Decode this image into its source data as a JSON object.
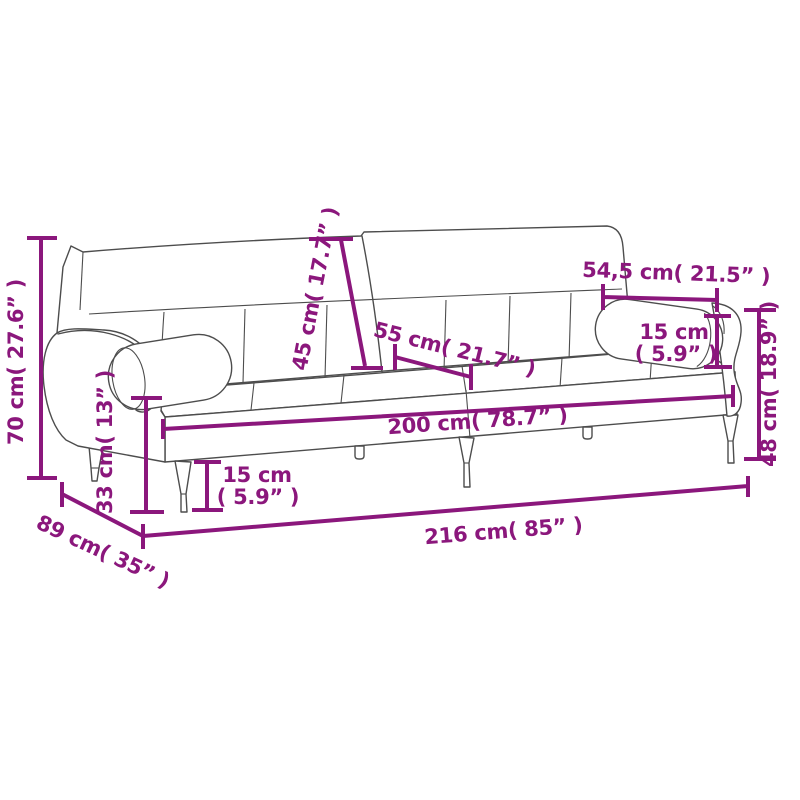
{
  "diagram": {
    "kind": "sofa-bed-dimension-diagram",
    "accent_color": "#8B177C",
    "line_art_color": "#4d4d4d",
    "background_color": "#ffffff"
  },
  "dimensions": {
    "overall_height": {
      "cm": 70,
      "in": 27.6,
      "label": "70 cm( 27.6” )"
    },
    "backrest_height": {
      "cm": 45,
      "in": 17.7,
      "label": "45 cm( 17.7” )"
    },
    "seat_depth": {
      "cm": 55,
      "in": 21.7,
      "label": "55 cm( 21.7” )"
    },
    "arm_cushion_length": {
      "cm": 54.5,
      "in": 21.5,
      "label": "54,5 cm( 21.5” )"
    },
    "arm_cushion_diameter": {
      "cm": 15,
      "in": 5.9,
      "label_line1": "15 cm",
      "label_line2": "( 5.9” )"
    },
    "armrest_height": {
      "cm": 48,
      "in": 18.9,
      "label": "48 cm( 18.9” )"
    },
    "seat_width": {
      "cm": 200,
      "in": 78.7,
      "label": "200 cm( 78.7” )"
    },
    "leg_height": {
      "cm": 15,
      "in": 5.9,
      "label_line1": "15 cm",
      "label_line2": "( 5.9” )"
    },
    "seat_height": {
      "cm": 33,
      "in": 13,
      "label": "33 cm( 13” )"
    },
    "base_depth": {
      "cm": 89,
      "in": 35,
      "label": "89 cm( 35” )"
    },
    "overall_width": {
      "cm": 216,
      "in": 85,
      "label": "216 cm( 85” )"
    }
  }
}
